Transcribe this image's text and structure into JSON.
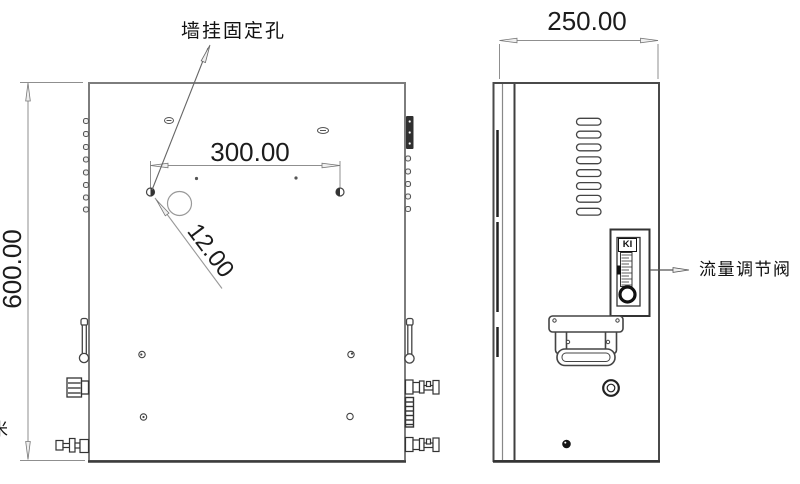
{
  "labels": {
    "wall_mount_hole": "墙挂固定孔",
    "flow_control_valve": "流量调节阀",
    "clipped_glyph": "米"
  },
  "dimensions": {
    "enclosure_height": "600.00",
    "enclosure_depth": "250.00",
    "mount_hole_spacing": "300.00",
    "mount_hole_diameter": "12.00",
    "diameter_symbol": "⌀"
  },
  "flowmeter": {
    "logo_text": "KI"
  },
  "colors": {
    "background": "#ffffff",
    "outline_gray": "#7d7d7d",
    "outline_dark": "#3c3c3c",
    "dimension_line": "#8f8f8f",
    "fitting_line": "#333333",
    "text": "#1c1c1c"
  }
}
